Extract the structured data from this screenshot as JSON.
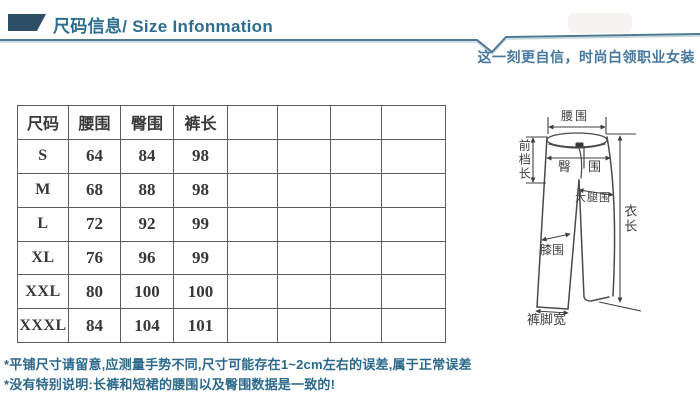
{
  "header": {
    "title": "尺码信息/ Size Infonmation",
    "tagline": "这一刻更自信，时尚白领职业女装"
  },
  "size_table": {
    "header": [
      "尺码",
      "腰围",
      "臀围",
      "裤长",
      "",
      "",
      "",
      ""
    ],
    "rows": [
      [
        "S",
        "64",
        "84",
        "98",
        "",
        "",
        "",
        ""
      ],
      [
        "M",
        "68",
        "88",
        "98",
        "",
        "",
        "",
        ""
      ],
      [
        "L",
        "72",
        "92",
        "99",
        "",
        "",
        "",
        ""
      ],
      [
        "XL",
        "76",
        "96",
        "99",
        "",
        "",
        "",
        ""
      ],
      [
        "XXL",
        "80",
        "100",
        "100",
        "",
        "",
        "",
        ""
      ],
      [
        "XXXL",
        "84",
        "104",
        "101",
        "",
        "",
        "",
        ""
      ]
    ]
  },
  "diagram": {
    "waist": "腰围",
    "front_rise": "前档长",
    "hip": "臀围",
    "thigh": "大腿围",
    "garment_length": "衣长",
    "knee": "膝围",
    "leg_opening": "裤脚宽"
  },
  "notes": [
    "*平铺尺寸请留意,应测量手势不同,尺寸可能存在1~2cm左右的误差,属于正常误差",
    "*没有特别说明:长裤和短裙的腰围以及臀围数据是一致的!"
  ],
  "colors": {
    "accent_teal": "#2f6d8e",
    "divider": "#4f7a94",
    "note_text": "#2b698b",
    "table_border": "#5c5c5c",
    "diagram_line": "#4a4a4a"
  }
}
